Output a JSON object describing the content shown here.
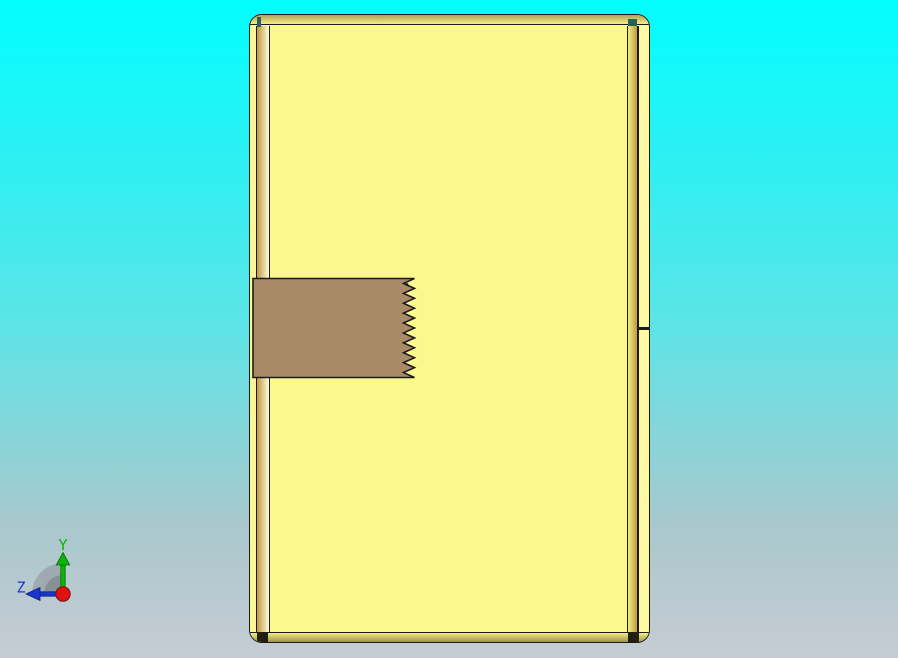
{
  "viewport": {
    "type": "3d-cad-front-view"
  },
  "model": {
    "teeth_count": 10
  },
  "triad": {
    "y_label": "Y",
    "z_label": "Z"
  },
  "colors": {
    "bg_top": "#02feff",
    "bg_mid": "#5ee4e6",
    "bg_low": "#a9c8cd",
    "bg_bottom": "#c6ccd3",
    "body": "#fbf88d",
    "edge": "#1b1b1b",
    "band_dark": "#b0a159",
    "band_light": "#f5ed84",
    "band_bottom_dark": "#9f9148",
    "strip_light": "#fbf69b",
    "strip_gold": "#be9a42",
    "strip_cream": "#fffcd8",
    "right_strip_light": "#fef9a5",
    "insert": "#a98a66",
    "notch_teal": "#2a6057",
    "notch_dark": "#20200f",
    "axis_y": "#0ab50a",
    "axis_y_dark": "#066f06",
    "axis_z": "#1a35cc",
    "axis_z_dark": "#0e1f7a",
    "origin_red": "#e01111",
    "origin_red_dark": "#7a0c0c",
    "fan_outer": "#9aa3a7",
    "fan_inner": "#828c91"
  }
}
